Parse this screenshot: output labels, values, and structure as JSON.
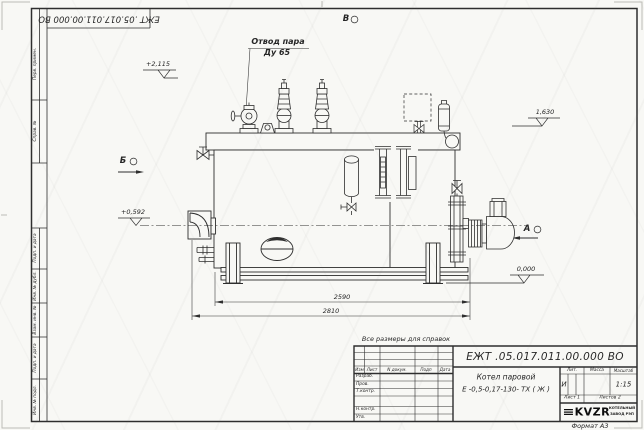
{
  "colors": {
    "line": "#2e2e2e",
    "sheet": "#f8f8f5",
    "logo": "#0d0d0d"
  },
  "margin": {
    "top_code": "ЕЖТ .05.017.011.00.000  ВО",
    "labels": [
      "Перв. примен.",
      "Справ. №",
      "Подп. и дата",
      "Инв. № дубл.",
      "Взам. инв. №",
      "Подп. и дата",
      "Инв. № подл."
    ]
  },
  "drawing": {
    "steam_label_1": "Отвод пара",
    "steam_label_2": "Ду 65",
    "view_top": "В",
    "view_left": "Б",
    "view_right": "А",
    "elev_1": "+2,115",
    "elev_2": "1,630",
    "elev_3": "+0,592",
    "elev_4": "0,000",
    "dim_1": "2590",
    "dim_2": "2810",
    "note": "Все размеры для справок"
  },
  "title_block": {
    "doc_number": "ЕЖТ .05.017.011.00.000  ВО",
    "name_line_1": "Котел паровой",
    "name_line_2": "Е -0,5-0,17-130- ТХ ( Ж )",
    "col_izm": "Изм",
    "col_list": "Лист",
    "col_ndoc": "N докум.",
    "col_podp": "Подп",
    "col_data": "Дата",
    "row_razrab": "Разраб.",
    "row_prov": "Пров.",
    "row_tkontr": "Т.контр.",
    "row_nkontr": "Н.контр.",
    "row_utv": "Утв.",
    "hdr_lit": "Лит.",
    "hdr_massa": "Масса",
    "hdr_scale": "Масштаб",
    "lit_value": "И",
    "scale_value": "1:15",
    "sheet_value": "Лист 1",
    "sheets_value": "Листов 2",
    "logo_text": "KVZR",
    "logo_sub_1": "КОТЕЛЬНЫЙ",
    "logo_sub_2": "ЗАВОД РЭП",
    "format_label": "Формат А3"
  }
}
